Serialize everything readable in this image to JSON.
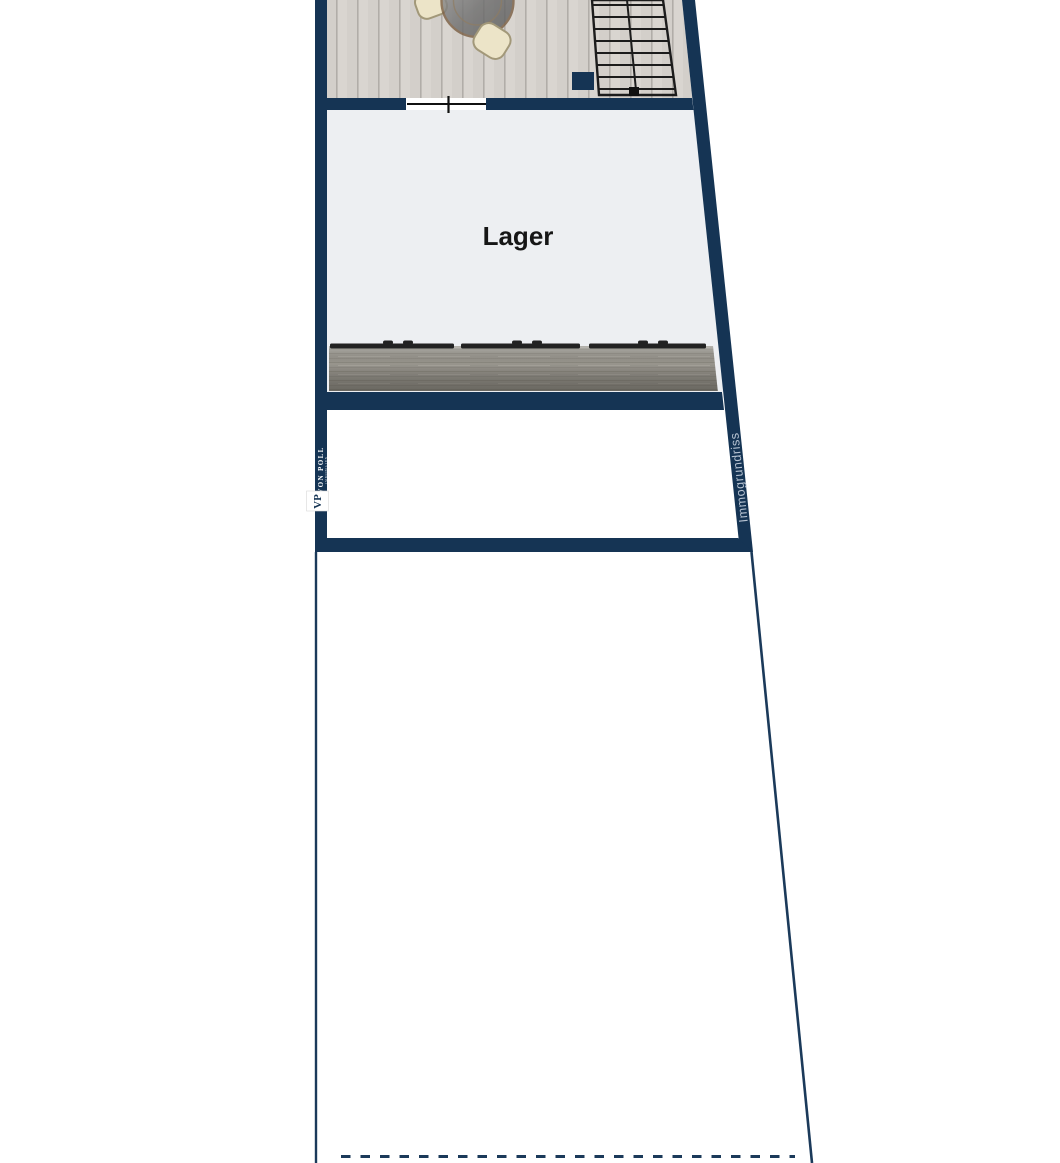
{
  "plan": {
    "rooms": [
      {
        "label": "Lager"
      }
    ],
    "branding": {
      "company": "VON POLL",
      "division": "IMMOBILIEN",
      "monogram": "VP",
      "watermark": "Immogrundriss"
    },
    "colors": {
      "wall": "#153454",
      "boundary_line": "#1b3a5a",
      "lager_floor": "#edeff2",
      "lower_floor": "#ffffff",
      "wood_floor": "#d9d5d0",
      "wood_joint": "#b1ada8",
      "garage_door_gray": "#98958d",
      "garage_door_bar": "#222222",
      "stair_outline": "#1c1c1c",
      "door_line": "#111111",
      "label_text": "#161616",
      "watermark_text": "#b7c3d2",
      "logo_text": "#ffffff",
      "chair_fill": "#ece4c8",
      "chair_stroke": "#a29879",
      "table_glass": "#757575",
      "table_rim": "#7c6146"
    }
  }
}
